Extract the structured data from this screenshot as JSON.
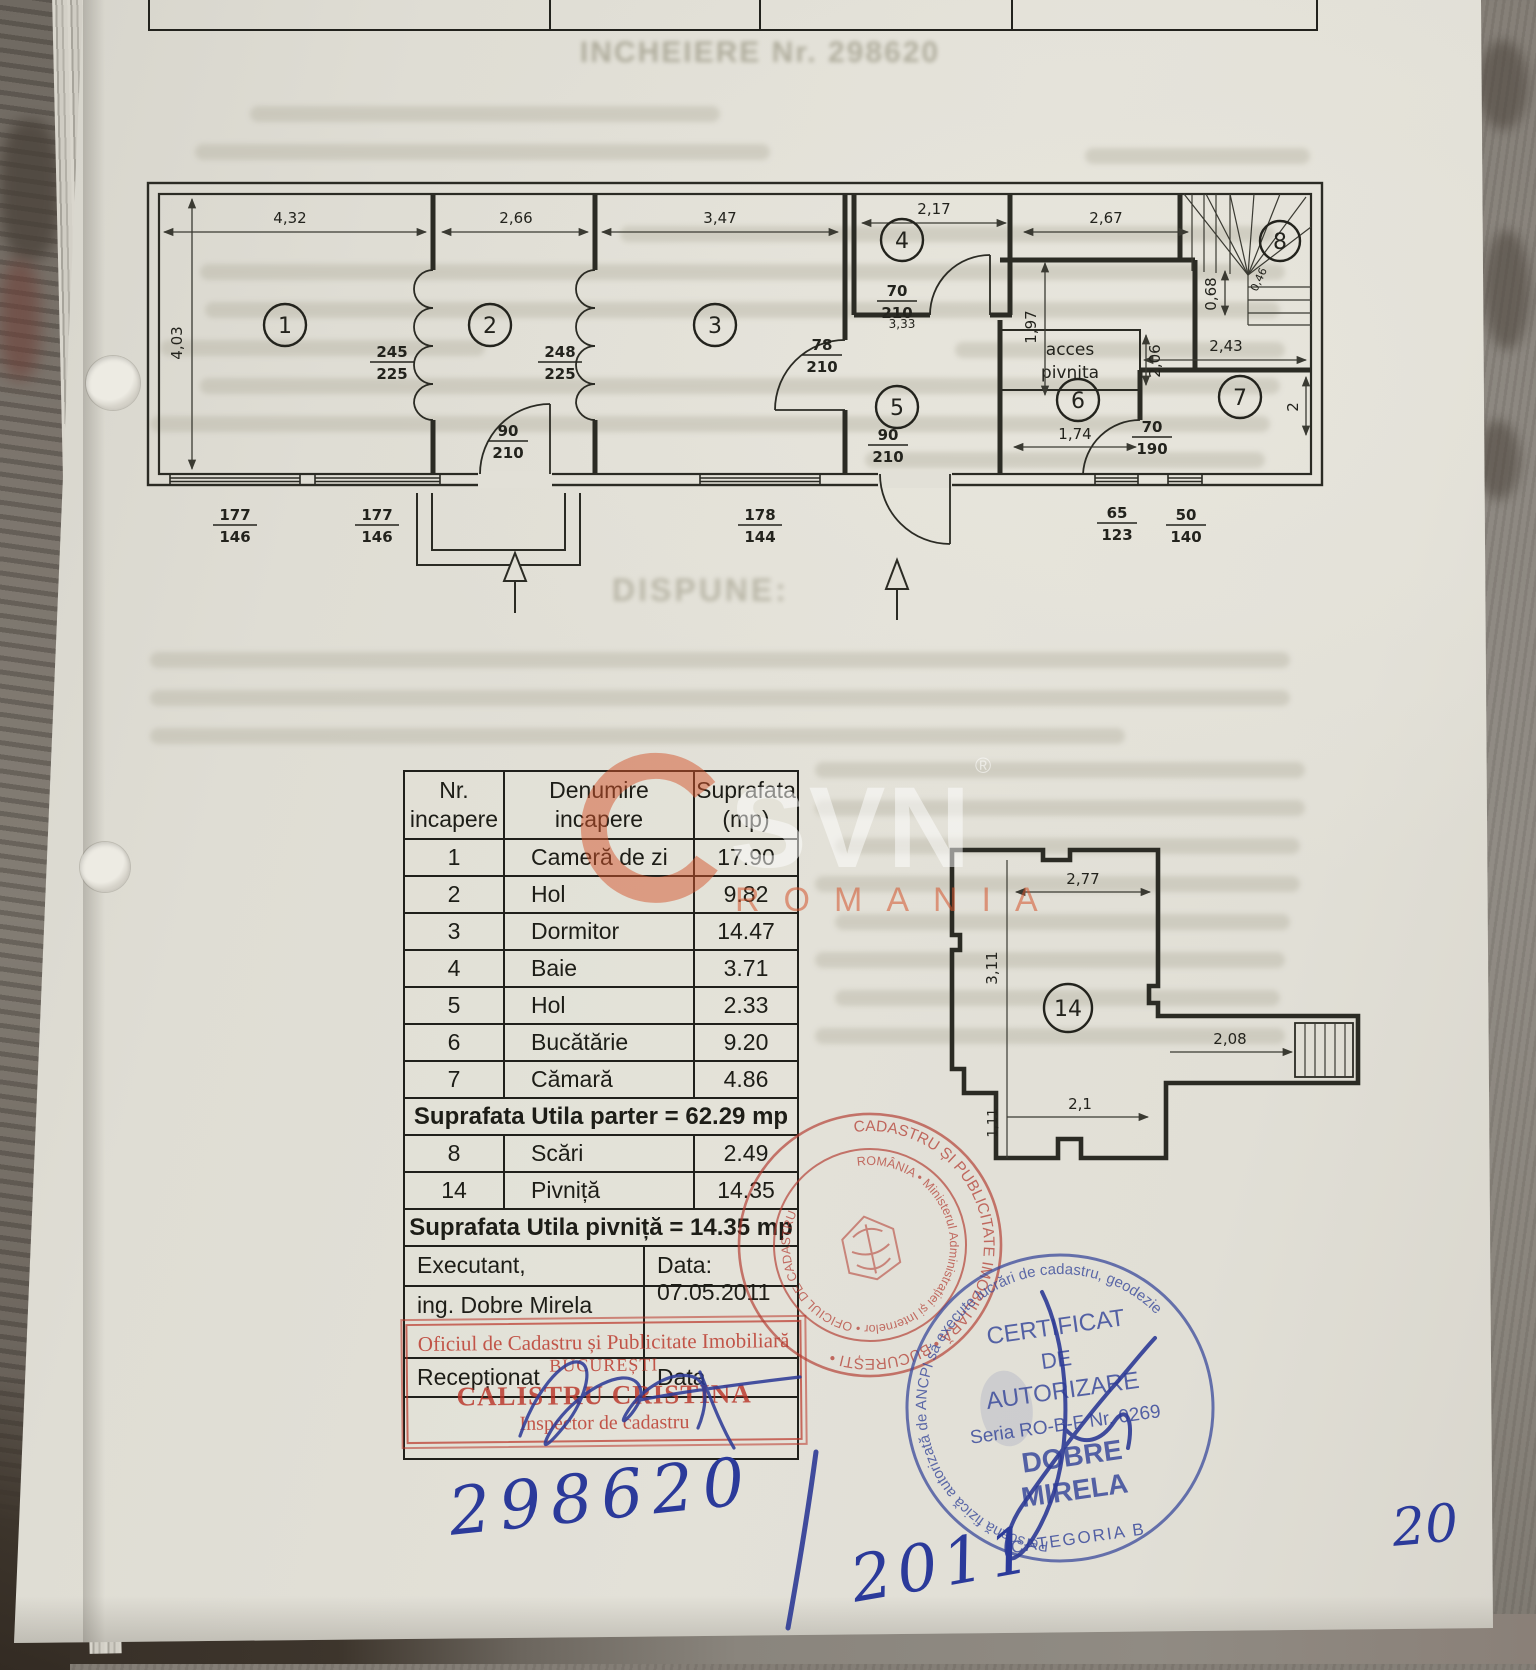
{
  "page": {
    "bleed_title": "INCHEIERE Nr. 298620",
    "bleed_dispune": "DISPUNE:"
  },
  "watermark": {
    "brand": "SVN",
    "reg": "®",
    "country": "ROMANIA"
  },
  "parter": {
    "rooms": {
      "r1": "1",
      "r2": "2",
      "r3": "3",
      "r4": "4",
      "r5": "5",
      "r6": "6",
      "r7": "7",
      "r8": "8"
    },
    "dims": {
      "d1": "4,32",
      "d2": "2,66",
      "d3": "3,47",
      "d4": "2,17",
      "d5": "2,67",
      "d6": "4,03",
      "d7": "1,97",
      "d8": "0,68",
      "d9": "2,43",
      "d10": "2",
      "d11": "1,74",
      "d12": "2,06",
      "d13": "3,33",
      "d14": "0,46"
    },
    "fractions": {
      "fr1": {
        "a": "245",
        "b": "225"
      },
      "fr2": {
        "a": "248",
        "b": "225"
      },
      "fr3": {
        "a": "78",
        "b": "210"
      },
      "fr4": {
        "a": "70",
        "b": "210"
      },
      "fr5": {
        "a": "90",
        "b": "210"
      },
      "fr6": {
        "a": "90",
        "b": "210"
      },
      "fr7": {
        "a": "70",
        "b": "190"
      },
      "fr8": {
        "a": "177",
        "b": "146"
      },
      "fr9": {
        "a": "177",
        "b": "146"
      },
      "fr10": {
        "a": "178",
        "b": "144"
      },
      "fr11": {
        "a": "65",
        "b": "123"
      },
      "fr12": {
        "a": "50",
        "b": "140"
      }
    },
    "acces": {
      "l1": "acces",
      "l2": "pivnita"
    }
  },
  "pivnita": {
    "room": "14",
    "dims": {
      "d1": "2,77",
      "d2": "3,11",
      "d3": "2,08",
      "d4": "2,1",
      "d5": "1,11"
    }
  },
  "table": {
    "headers": {
      "c1a": "Nr.",
      "c1b": "incapere",
      "c2a": "Denumire",
      "c2b": "incapere",
      "c3a": "Suprafata",
      "c3b": "(mp)"
    },
    "rows": [
      {
        "n": "1",
        "name": "Cameră de zi",
        "area": "17.90"
      },
      {
        "n": "2",
        "name": "Hol",
        "area": "9.82"
      },
      {
        "n": "3",
        "name": "Dormitor",
        "area": "14.47"
      },
      {
        "n": "4",
        "name": "Baie",
        "area": "3.71"
      },
      {
        "n": "5",
        "name": "Hol",
        "area": "2.33"
      },
      {
        "n": "6",
        "name": "Bucătărie",
        "area": "9.20"
      },
      {
        "n": "7",
        "name": "Cămară",
        "area": "4.86"
      }
    ],
    "total_parter": "Suprafata Utila parter = 62.29 mp",
    "rows2": [
      {
        "n": "8",
        "name": "Scări",
        "area": "2.49"
      },
      {
        "n": "14",
        "name": "Pivniță",
        "area": "14.35"
      }
    ],
    "total_pivnita": "Suprafata Utila pivniță = 14.35 mp",
    "executant_label": "Executant,",
    "executant_name": "ing. Dobre Mirela",
    "date_label": "Data: 07.05.2011",
    "receptionat_label": "Recepționat",
    "data_label": "Data"
  },
  "stamps": {
    "rect": {
      "line1": "Oficiul de Cadastru și Publicitate Imobiliară",
      "line2": "BUCUREȘTI",
      "line3": "CALISTRU CRISTINA",
      "line4": "Inspector de cadastru"
    },
    "red_round": {
      "ring_outer": "CADASTRU ȘI PUBLICITATE IMOBILIARĂ • BUCUREȘTI •",
      "ring_inner": "ROMÂNIA • Ministerul Administrației și Internelor • OFICIUL DE CADASTRU"
    },
    "blue_round": {
      "ring_top": "Persoană fizică autorizată de ANCPI să execute lucrări de cadastru, geodezie",
      "ring_bottom": "CATEGORIA B",
      "line1": "CERTIFICAT",
      "line2": "DE",
      "line3": "AUTORIZARE",
      "line4": "Seria RO-B-F Nr. 0269",
      "line5": "DOBRE",
      "line6": "MIRELA"
    }
  },
  "handwriting": {
    "number": "298620",
    "year": "2011",
    "page": "20"
  }
}
